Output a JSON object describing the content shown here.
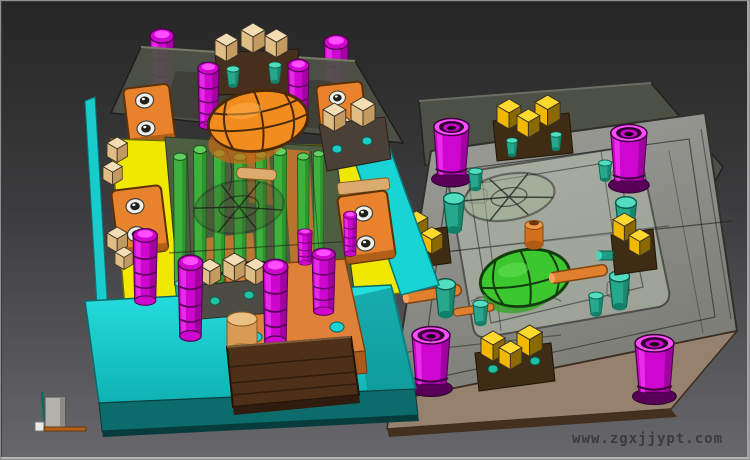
{
  "watermark": {
    "text": "www.zgxjjypt.com"
  },
  "palette": {
    "bg_top": "#262626",
    "bg_bottom": "#68686c",
    "frame": "#8f8f8f",
    "magenta": "#cf06cf",
    "magenta_light": "#ff4dff",
    "magenta_dark": "#800080",
    "orange": "#e8822c",
    "orange_dark": "#a85614",
    "yellow": "#f0e800",
    "yellow_dark": "#7d7d04",
    "green": "#3cb23c",
    "green_dark": "#2a8a2a",
    "ball_orange": "#f28c1e",
    "ball_green": "#3cc72e",
    "cyan": "#18d4d4",
    "cyan_dark": "#0c6b6b",
    "teal": "#26a88c",
    "tan": "#ecd0a0",
    "brown": "#4e3018",
    "dark_brown": "#2f1c0e",
    "plate_gray": "#90908c",
    "plate_side": "#96806e",
    "glass": "#b6c2ae",
    "olive": "#4e5246",
    "wire": "#1c1c1c",
    "watermark_color": "#3b3b3b",
    "axis_box": "#b3b1ab",
    "axis_teal": "#0d6b5c",
    "axis_orange": "#b06018"
  }
}
